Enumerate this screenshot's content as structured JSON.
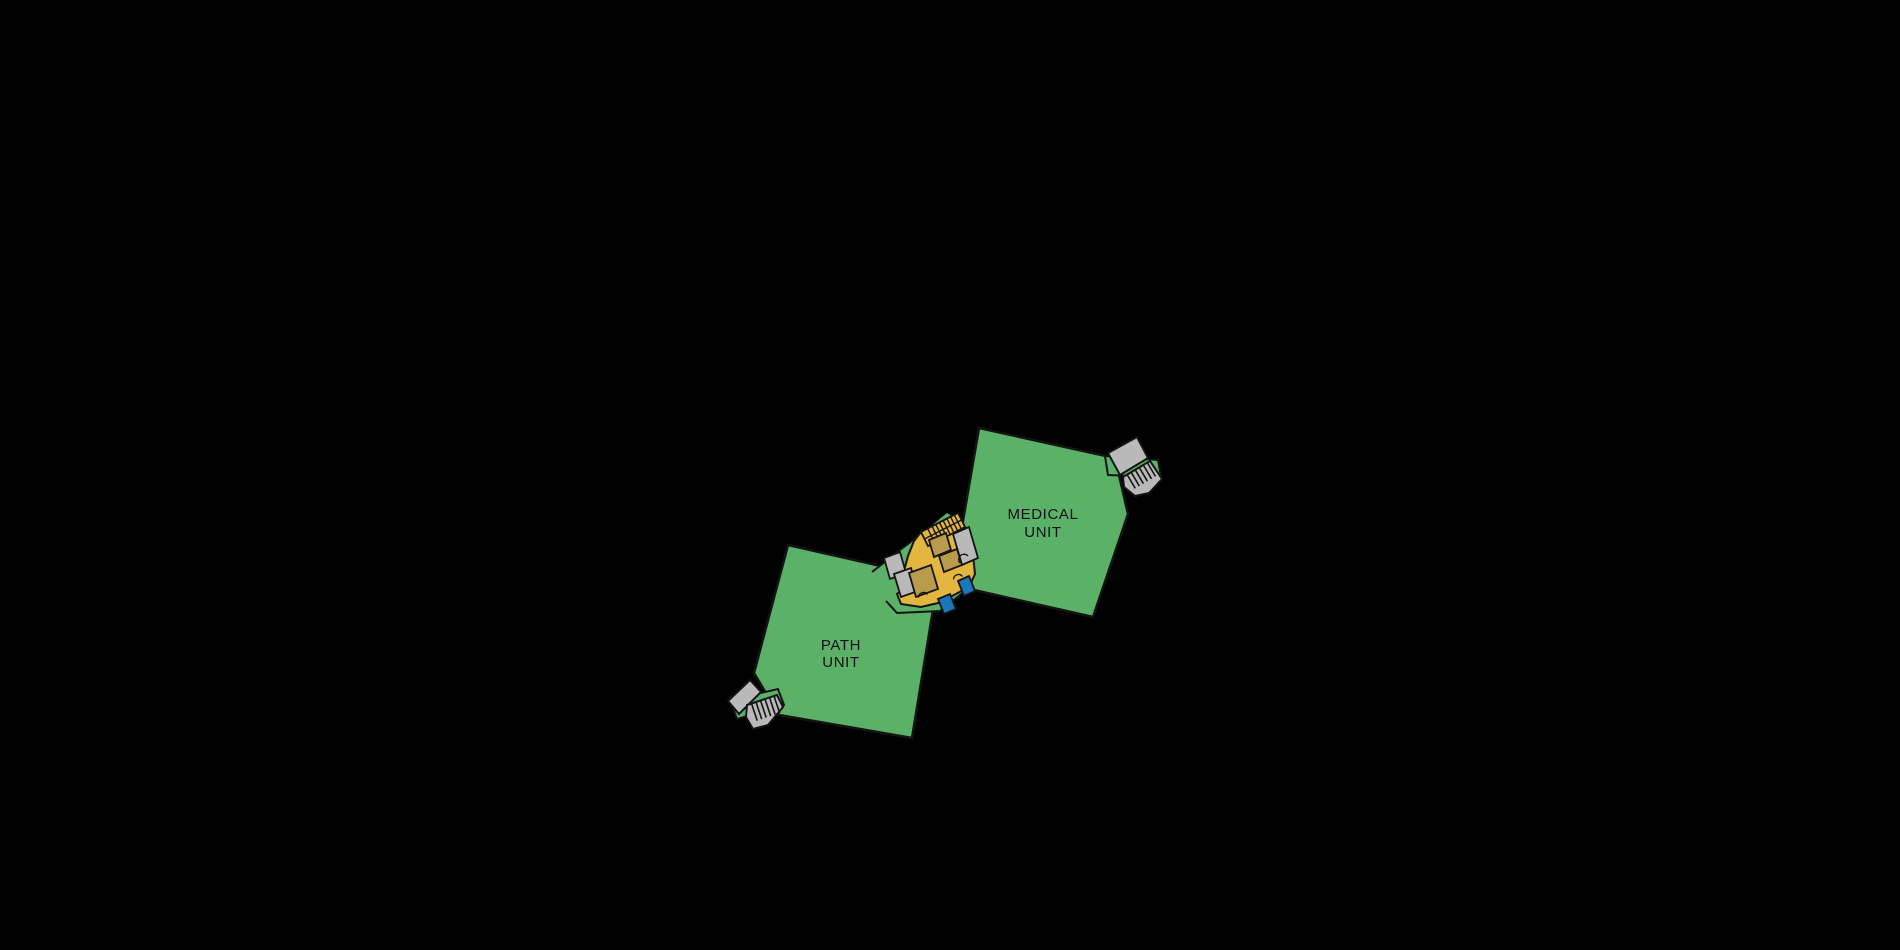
{
  "colors": {
    "background": "#000000",
    "unit_green": "#5CB168",
    "building_yellow": "#E3B640",
    "room_tan": "#B89C4B",
    "structure_gray": "#B9B9B9",
    "door_blue": "#1C76BC",
    "outline": "#141414",
    "label_text": "#111111"
  },
  "units": [
    {
      "id": "medical-unit",
      "label_lines": [
        "MEDICAL",
        "UNIT"
      ]
    },
    {
      "id": "path-unit",
      "label_lines": [
        "PATH",
        "UNIT"
      ]
    }
  ],
  "floorplan": {
    "shapes": [
      {
        "name": "path-unit",
        "type": "polygon",
        "fill": "unit_green",
        "sw": 2.5,
        "interactable": "true",
        "pts": "788,545 938,579 912,738 779,715 754,673"
      },
      {
        "name": "medical-unit",
        "type": "polygon",
        "fill": "unit_green",
        "sw": 2.5,
        "interactable": "true",
        "pts": "979,428 1115,458 1128,514 1093,617 952,585"
      },
      {
        "name": "connector-green",
        "type": "polygon",
        "fill": "unit_green",
        "sw": 0,
        "interactable": "false",
        "pts": "872,572 900,550 920,535 947,513 963,523 970,587 940,611 897,613 886,601"
      },
      {
        "name": "connector-outline-upper",
        "type": "polyline",
        "fill": "none",
        "sw": 2,
        "interactable": "false",
        "pts": "872,572 900,550 920,535"
      },
      {
        "name": "connector-outline-lower",
        "type": "polyline",
        "fill": "none",
        "sw": 2,
        "interactable": "false",
        "pts": "970,587 940,611 897,613 886,601"
      },
      {
        "name": "stair-strip-ne",
        "type": "polygon",
        "fill": "unit_green",
        "sw": 2,
        "interactable": "false",
        "pts": "1105,456 1158,460 1161,477 1108,475"
      },
      {
        "name": "stair-strip-sw",
        "type": "polygon",
        "fill": "unit_green",
        "sw": 2,
        "interactable": "false",
        "pts": "730,700 778,689 784,705 737,719"
      },
      {
        "name": "ramp-ne",
        "type": "polygon",
        "fill": "structure_gray",
        "sw": 2,
        "interactable": "false",
        "pts": "1108,453 1137,437 1148,458 1120,475"
      },
      {
        "name": "ramp-sw",
        "type": "polygon",
        "fill": "structure_gray",
        "sw": 2,
        "interactable": "false",
        "pts": "728,701 750,680 761,692 739,714"
      },
      {
        "name": "stair-ne",
        "type": "polygon",
        "fill": "structure_gray",
        "sw": 2,
        "interactable": "false",
        "pts": "1123,477 1150,461 1162,479 1149,493 1135,496 1124,487"
      },
      {
        "name": "stair-sw",
        "type": "polygon",
        "fill": "structure_gray",
        "sw": 2,
        "interactable": "false",
        "pts": "747,705 777,695 783,707 768,725 753,729 746,717"
      },
      {
        "name": "stair-ne-tread",
        "type": "line",
        "sw": 1.6,
        "interactable": "false",
        "x1": 1127.1,
        "y1": 474.6,
        "x2": 1135.3,
        "y2": 488.4
      },
      {
        "name": "stair-ne-tread",
        "type": "line",
        "sw": 1.6,
        "interactable": "false",
        "x1": 1131.1,
        "y1": 472.2,
        "x2": 1139.3,
        "y2": 486.0
      },
      {
        "name": "stair-ne-tread",
        "type": "line",
        "sw": 1.6,
        "interactable": "false",
        "x1": 1135.2,
        "y1": 469.8,
        "x2": 1143.4,
        "y2": 483.6
      },
      {
        "name": "stair-ne-tread",
        "type": "line",
        "sw": 1.6,
        "interactable": "false",
        "x1": 1139.2,
        "y1": 467.4,
        "x2": 1147.4,
        "y2": 481.2
      },
      {
        "name": "stair-ne-tread",
        "type": "line",
        "sw": 1.6,
        "interactable": "false",
        "x1": 1143.3,
        "y1": 465.0,
        "x2": 1151.5,
        "y2": 478.8
      },
      {
        "name": "stair-ne-tread",
        "type": "line",
        "sw": 1.6,
        "interactable": "false",
        "x1": 1147.3,
        "y1": 462.6,
        "x2": 1155.5,
        "y2": 476.4
      },
      {
        "name": "stair-sw-tread",
        "type": "line",
        "sw": 1.6,
        "interactable": "false",
        "x1": 751.5,
        "y1": 703.5,
        "x2": 757.2,
        "y2": 720.6
      },
      {
        "name": "stair-sw-tread",
        "type": "line",
        "sw": 1.6,
        "interactable": "false",
        "x1": 756.0,
        "y1": 702.0,
        "x2": 761.7,
        "y2": 719.1
      },
      {
        "name": "stair-sw-tread",
        "type": "line",
        "sw": 1.6,
        "interactable": "false",
        "x1": 760.5,
        "y1": 700.5,
        "x2": 766.2,
        "y2": 717.6
      },
      {
        "name": "stair-sw-tread",
        "type": "line",
        "sw": 1.6,
        "interactable": "false",
        "x1": 765.0,
        "y1": 699.0,
        "x2": 770.7,
        "y2": 716.1
      },
      {
        "name": "stair-sw-tread",
        "type": "line",
        "sw": 1.6,
        "interactable": "false",
        "x1": 769.5,
        "y1": 697.5,
        "x2": 775.2,
        "y2": 714.6
      },
      {
        "name": "stair-sw-tread",
        "type": "line",
        "sw": 1.6,
        "interactable": "false",
        "x1": 774.0,
        "y1": 696.0,
        "x2": 779.7,
        "y2": 713.1
      },
      {
        "name": "central-building-core",
        "type": "polygon",
        "fill": "building_yellow",
        "sw": 2,
        "interactable": "false",
        "pts": "921,532 958,513 966,529 973,555 975,574 969,587 952,596 938,603 921,607 901,604 897,594 906,587 904,571 908,556 914,541"
      },
      {
        "name": "stairwell-wing",
        "type": "polygon",
        "fill": "building_yellow",
        "sw": 1.8,
        "interactable": "false",
        "pts": "921,532 958,513 965,527 928,546"
      },
      {
        "name": "stairwell-centerline",
        "type": "line",
        "sw": 1.4,
        "interactable": "false",
        "x1": 924.5,
        "y1": 539.0,
        "x2": 961.5,
        "y2": 520.0
      },
      {
        "name": "stairwell-landing-line",
        "type": "line",
        "sw": 1.4,
        "interactable": "false",
        "x1": 927.7,
        "y1": 528.6,
        "x2": 934.7,
        "y2": 542.6
      },
      {
        "name": "stairwell-tread",
        "type": "line",
        "sw": 1.4,
        "interactable": "false",
        "x1": 932.1,
        "y1": 526.3,
        "x2": 939.1,
        "y2": 540.3
      },
      {
        "name": "stairwell-tread",
        "type": "line",
        "sw": 1.4,
        "interactable": "false",
        "x1": 935.8,
        "y1": 524.4,
        "x2": 942.8,
        "y2": 538.4
      },
      {
        "name": "stairwell-tread",
        "type": "line",
        "sw": 1.4,
        "interactable": "false",
        "x1": 939.5,
        "y1": 522.5,
        "x2": 946.5,
        "y2": 536.5
      },
      {
        "name": "stairwell-tread",
        "type": "line",
        "sw": 1.4,
        "interactable": "false",
        "x1": 943.2,
        "y1": 520.6,
        "x2": 950.2,
        "y2": 534.6
      },
      {
        "name": "stairwell-tread",
        "type": "line",
        "sw": 1.4,
        "interactable": "false",
        "x1": 946.9,
        "y1": 518.7,
        "x2": 953.9,
        "y2": 532.7
      },
      {
        "name": "stairwell-tread",
        "type": "line",
        "sw": 1.4,
        "interactable": "false",
        "x1": 950.6,
        "y1": 516.8,
        "x2": 957.6,
        "y2": 530.8
      },
      {
        "name": "stairwell-tread",
        "type": "line",
        "sw": 1.4,
        "interactable": "false",
        "x1": 954.3,
        "y1": 514.9,
        "x2": 961.3,
        "y2": 528.9
      },
      {
        "name": "block-gray-right",
        "type": "polygon",
        "fill": "structure_gray",
        "sw": 1.8,
        "interactable": "false",
        "pts": "953,534 969,527 978,558 962,565"
      },
      {
        "name": "block-gray-left-upper",
        "type": "polygon",
        "fill": "structure_gray",
        "sw": 1.8,
        "interactable": "false",
        "pts": "884,558 900,552 906,573 890,579"
      },
      {
        "name": "block-gray-left-lower",
        "type": "polygon",
        "fill": "structure_gray",
        "sw": 1.8,
        "interactable": "false",
        "pts": "894,574 911,568 918,591 901,597"
      },
      {
        "name": "room-tan-1",
        "type": "polygon",
        "fill": "room_tan",
        "sw": 1.8,
        "interactable": "false",
        "pts": "929,540 946,533 951,550 934,557"
      },
      {
        "name": "room-tan-2",
        "type": "polygon",
        "fill": "room_tan",
        "sw": 1.8,
        "interactable": "false",
        "pts": "939,556 957,549 962,565 944,572"
      },
      {
        "name": "room-tan-3",
        "type": "polygon",
        "fill": "room_tan",
        "sw": 1.8,
        "interactable": "false",
        "pts": "909,573 931,565 938,589 916,597"
      },
      {
        "name": "door-blue-1",
        "type": "polygon",
        "fill": "door_blue",
        "sw": 1.8,
        "interactable": "false",
        "pts": "938,599 950,594 956,609 944,614"
      },
      {
        "name": "door-blue-2",
        "type": "polygon",
        "fill": "door_blue",
        "sw": 1.8,
        "interactable": "false",
        "pts": "958,581 969,576 975,591 964,596"
      },
      {
        "name": "door-arc-1",
        "type": "path",
        "fill": "none",
        "sw": 1.3,
        "interactable": "false",
        "d": "M 918.5 597.5 A 5 5 0 0 1 927.5 594.5"
      },
      {
        "name": "door-arc-2",
        "type": "path",
        "fill": "none",
        "sw": 1.3,
        "interactable": "false",
        "d": "M 953.5 579.5 A 5 5 0 0 1 962.5 576.5"
      },
      {
        "name": "door-arc-3",
        "type": "path",
        "fill": "none",
        "sw": 1.3,
        "interactable": "false",
        "d": "M 960 563 A 5 5 0 0 1 968 556"
      }
    ],
    "labels": [
      {
        "name": "medical-unit-label",
        "x": 1043,
        "line1_y": 519,
        "line2_y": 537
      },
      {
        "name": "path-unit-label",
        "x": 841,
        "line1_y": 650,
        "line2_y": 667
      }
    ]
  }
}
